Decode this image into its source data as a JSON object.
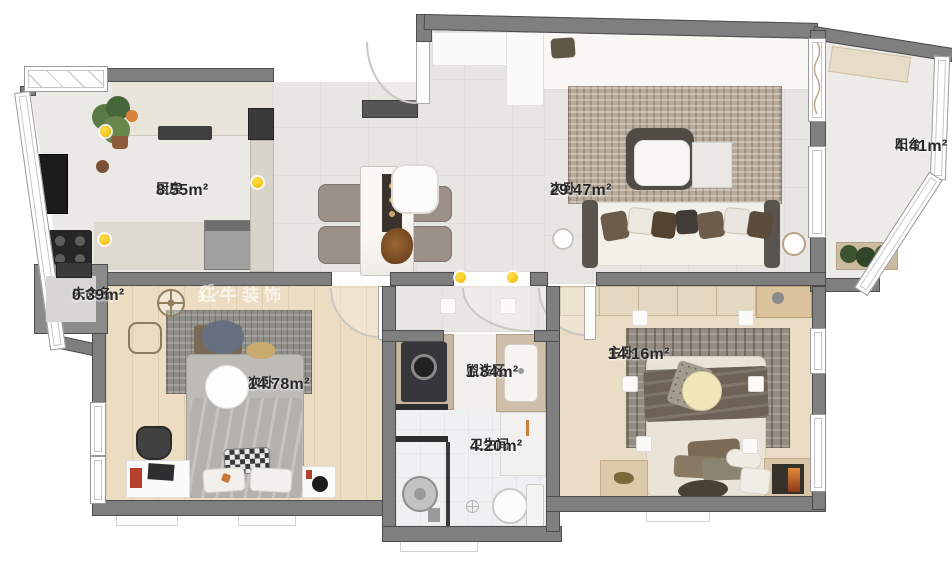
{
  "watermark": {
    "brand": "红牛装饰",
    "logo": "bull-icon"
  },
  "rooms": {
    "kitchen": {
      "name": "厨房",
      "area": "8.55m²"
    },
    "living": {
      "name": "次卧",
      "area": "29.47m²"
    },
    "balcony": {
      "name": "阳台",
      "area": "4.41m²"
    },
    "unnamed": {
      "name": "未命名",
      "area": "0.39m²"
    },
    "bedroom2": {
      "name": "次卧",
      "area": "14.78m²"
    },
    "wash": {
      "name": "盥洗区",
      "area": "1.84m²"
    },
    "bathroom": {
      "name": "卫生间",
      "area": "4.20m²"
    },
    "master": {
      "name": "主卧",
      "area": "14.16m²"
    }
  },
  "colors": {
    "wall": "#7f7f7f",
    "wall_edge": "#4c4c4c",
    "wood_floor": "#ecddc2",
    "tile_floor": "#e8e6e3",
    "accent_dot": "#f2b600",
    "watermark": "#ffffff"
  }
}
